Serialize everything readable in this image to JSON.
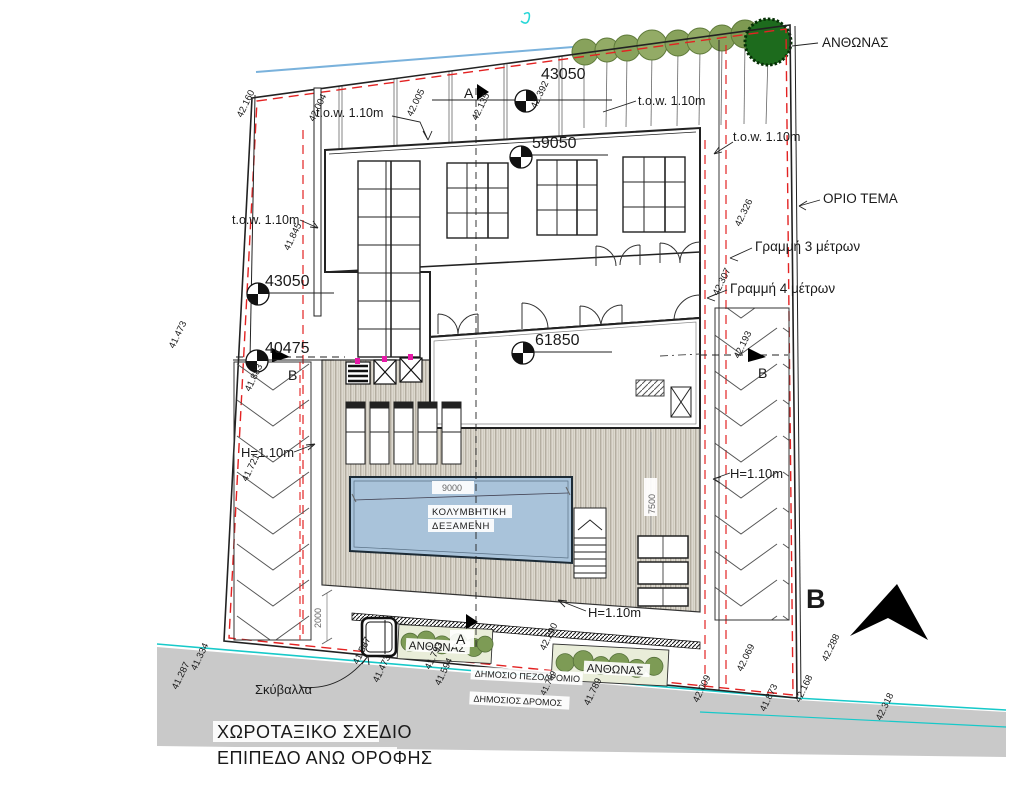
{
  "labels": {
    "anthonas": "ΑΝΘΩΝΑΣ",
    "orio_tema": "ΟΡΙΟ ΤΕΜΑ",
    "grammi_3": "Γραμμή 3 μέτρων",
    "grammi_4": "Γραμμή 4 μέτρων",
    "tow": "t.o.w. 1.10m",
    "h_wall": "H=1.10m",
    "pool_line1": "ΚΟΛΥΜΒΗΤΙΚΗ",
    "pool_line2": "ΔΕΞΑΜΕΝΗ",
    "skyvalla": "Σκύβαλλα",
    "sidewalk": "ΔΗΜΟΣΙΟ ΠΕΖΟΔΡΟΜΙΟ",
    "road": "ΔΗΜΟΣΙΟΣ ΔΡΟΜΟΣ",
    "title_line1": "ΧΩΡΟΤΑΞΙΚΟ ΣΧΕΔΙΟ",
    "title_line2": "ΕΠΙΠΕΔΟ ΑΝΩ ΟΡΟΦΗΣ",
    "section_a": "A",
    "section_b": "B",
    "north_letter": "B"
  },
  "levels": {
    "top_43050": "43050",
    "hall_59050": "59050",
    "block_61850": "61850",
    "left_43050": "43050",
    "left_40475": "40475"
  },
  "dimensions": {
    "pool_length": "9000",
    "pool_width": "7500",
    "gap": "2000"
  },
  "colors": {
    "boundary_red": "#e32222",
    "contour_cyan": "#17c9c9",
    "elev_blue": "#2424de",
    "pool_blue": "#a9c3da",
    "road_gray": "#c9c9c9",
    "deck_tan": "#ddd9cf",
    "tree_olive": "#88a25c",
    "tree_dark": "#1d6b1d"
  },
  "spot_elevations": [
    {
      "v": "42.160",
      "x": 242,
      "y": 118,
      "color": "#e32222"
    },
    {
      "v": "42.004",
      "x": 314,
      "y": 122,
      "color": "#e32222"
    },
    {
      "v": "42.005",
      "x": 412,
      "y": 117,
      "color": "#e32222"
    },
    {
      "v": "42.135",
      "x": 477,
      "y": 121,
      "color": "#e32222"
    },
    {
      "v": "42.392",
      "x": 536,
      "y": 109,
      "color": "#e32222"
    },
    {
      "v": "41.845",
      "x": 289,
      "y": 251,
      "color": "#e32222"
    },
    {
      "v": "41.883",
      "x": 250,
      "y": 392,
      "color": "#e32222"
    },
    {
      "v": "41.721",
      "x": 247,
      "y": 482,
      "color": "#e32222"
    },
    {
      "v": "42.326",
      "x": 740,
      "y": 227,
      "color": "#e32222"
    },
    {
      "v": "42.307",
      "x": 718,
      "y": 296,
      "color": "#e32222"
    },
    {
      "v": "42.193",
      "x": 739,
      "y": 359,
      "color": "#e32222"
    },
    {
      "v": "42.290",
      "x": 545,
      "y": 651,
      "color": "#e32222"
    },
    {
      "v": "42.069",
      "x": 742,
      "y": 672,
      "color": "#e32222"
    },
    {
      "v": "41.473",
      "x": 174,
      "y": 349,
      "color": "#17d2d2"
    },
    {
      "v": "42.288",
      "x": 827,
      "y": 662,
      "color": "#17d2d2"
    },
    {
      "v": "41.334",
      "x": 196,
      "y": 671,
      "color": "#2424de"
    },
    {
      "v": "41.287",
      "x": 177,
      "y": 690,
      "color": "#2424de"
    },
    {
      "v": "41.587",
      "x": 358,
      "y": 665,
      "color": "#2424de"
    },
    {
      "v": "41.473",
      "x": 378,
      "y": 683,
      "color": "#2424de"
    },
    {
      "v": "41.793",
      "x": 430,
      "y": 670,
      "color": "#2424de"
    },
    {
      "v": "41.594",
      "x": 440,
      "y": 686,
      "color": "#2424de"
    },
    {
      "v": "41.789",
      "x": 589,
      "y": 706,
      "color": "#2424de"
    },
    {
      "v": "42.009",
      "x": 698,
      "y": 703,
      "color": "#2424de"
    },
    {
      "v": "41.873",
      "x": 765,
      "y": 712,
      "color": "#2424de"
    },
    {
      "v": "41.789",
      "x": 545,
      "y": 696,
      "color": "#222222",
      "size": 8.5
    },
    {
      "v": "42.168",
      "x": 800,
      "y": 703,
      "color": "#222222"
    },
    {
      "v": "42.318",
      "x": 881,
      "y": 721,
      "color": "#222222"
    }
  ]
}
